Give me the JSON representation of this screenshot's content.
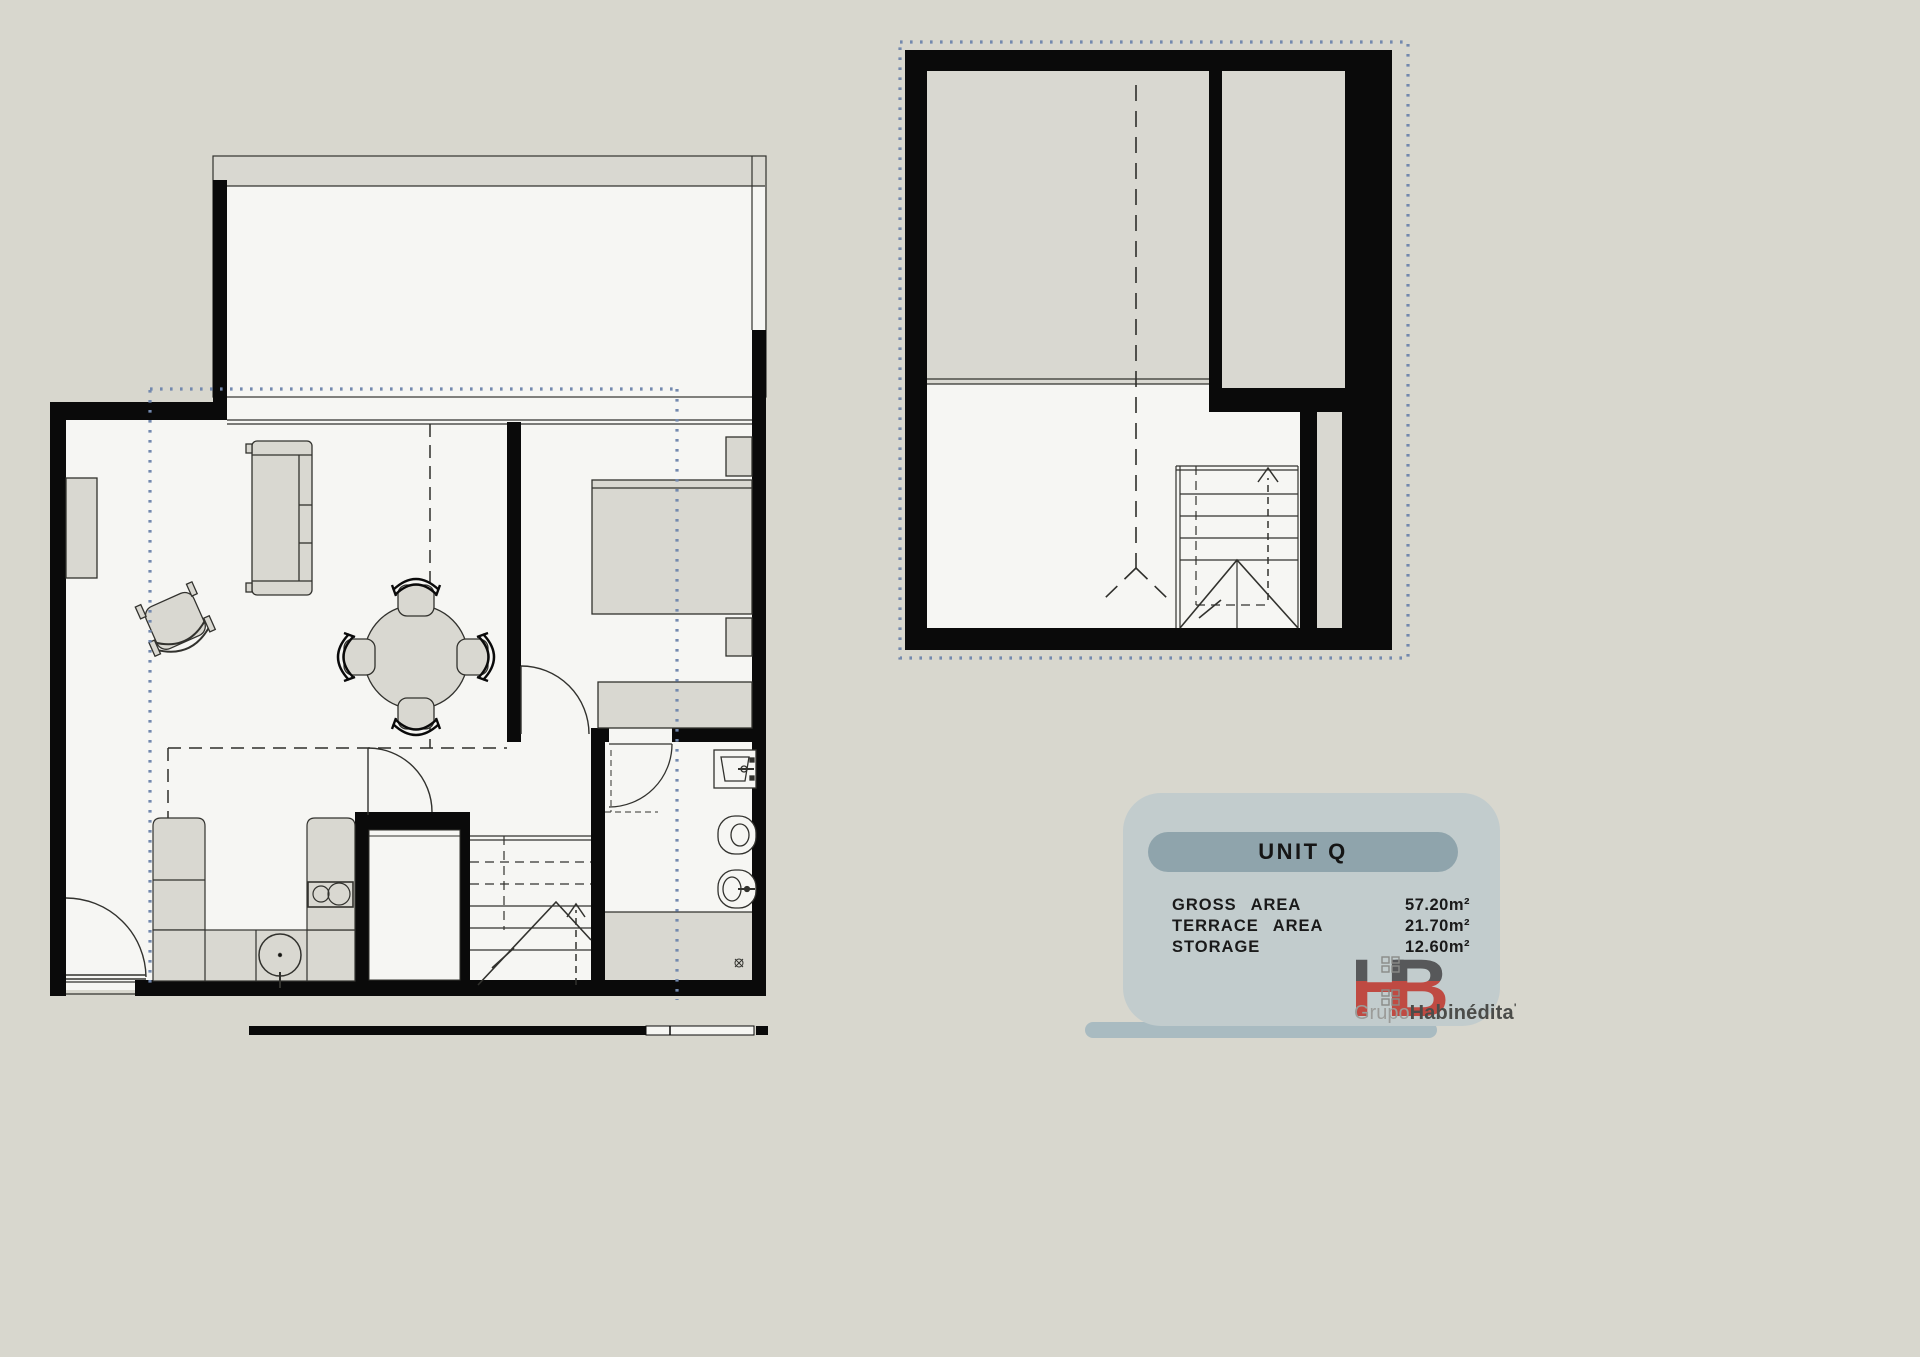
{
  "page": {
    "background_color": "#d8d7ce"
  },
  "panel": {
    "title": "UNIT Q",
    "rows": [
      {
        "label": "GROSS AREA",
        "value": "57.20m²"
      },
      {
        "label": "TERRACE AREA",
        "value": "21.70m²"
      },
      {
        "label": "STORAGE",
        "value": "12.60m²"
      }
    ],
    "colors": {
      "panel": "#c2cccd",
      "pill": "#8fa4ac",
      "shadow_bar": "#a9bbc1",
      "text": "#1a1a1a"
    }
  },
  "logo": {
    "monogram": "HB",
    "prefix": "Grupo",
    "name": "Habinédita",
    "mark": "'",
    "colors": {
      "monogram_gray": "#57585a",
      "monogram_red": "#bf4a42",
      "prefix_text": "#9b9c99",
      "name_text": "#4b4c49"
    }
  },
  "drawing": {
    "overlay_dot_color": "#7389ae",
    "wall_color": "#0a0a0a",
    "floor_color": "#f6f6f3",
    "furniture_fill_color": "#d9d8d1",
    "line_color": "#32322e"
  }
}
